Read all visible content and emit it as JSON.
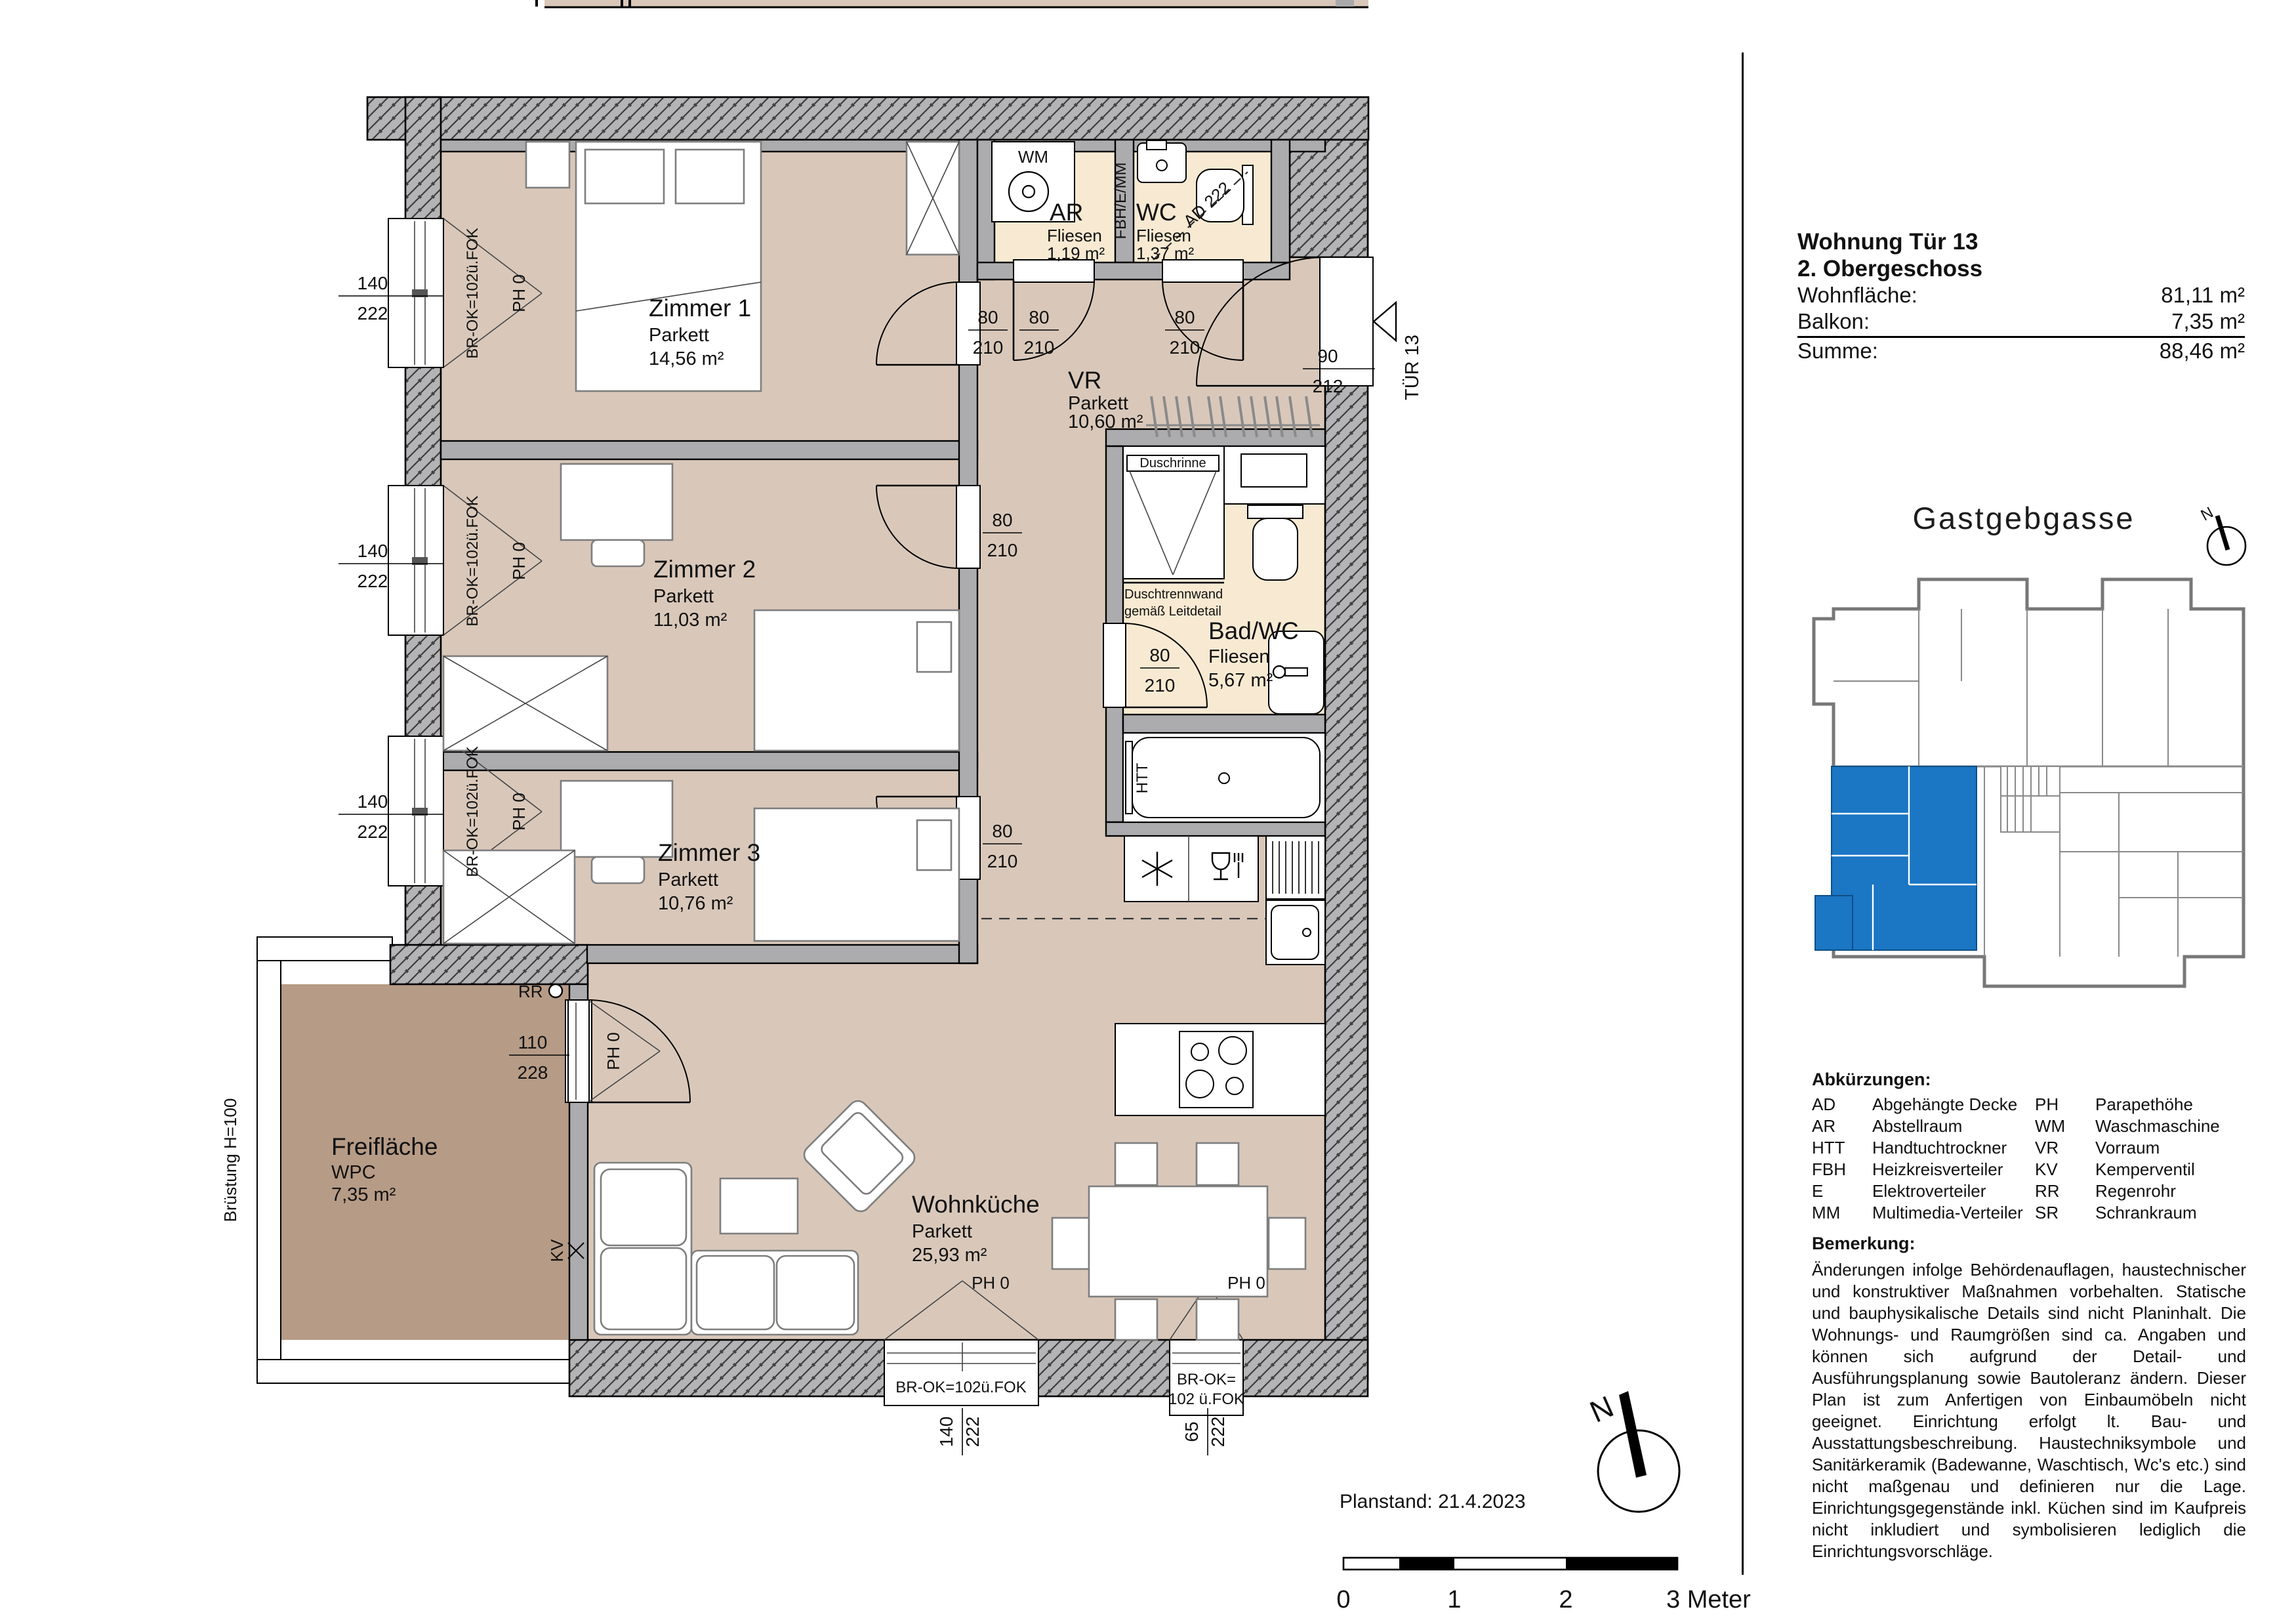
{
  "info": {
    "title": "Wohnung Tür 13",
    "floor": "2. Obergeschoss",
    "rows": [
      {
        "label": "Wohnfläche:",
        "value": "81,11 m²"
      },
      {
        "label": "Balkon:",
        "value": "7,35 m²"
      },
      {
        "label": "Summe:",
        "value": "88,46 m²"
      }
    ]
  },
  "site": {
    "street": "Gastgebgasse"
  },
  "rooms": {
    "z1": {
      "name": "Zimmer 1",
      "floor": "Parkett",
      "area": "14,56 m²"
    },
    "z2": {
      "name": "Zimmer 2",
      "floor": "Parkett",
      "area": "11,03 m²"
    },
    "z3": {
      "name": "Zimmer 3",
      "floor": "Parkett",
      "area": "10,76 m²"
    },
    "vr": {
      "name": "VR",
      "floor": "Parkett",
      "area": "10,60 m²"
    },
    "ar": {
      "name": "AR",
      "floor": "Fliesen",
      "area": "1,19 m²"
    },
    "wc": {
      "name": "WC",
      "floor": "Fliesen",
      "area": "1,37 m²"
    },
    "bad": {
      "name": "Bad/WC",
      "floor": "Fliesen",
      "area": "5,67 m²"
    },
    "wk": {
      "name": "Wohnküche",
      "floor": "Parkett",
      "area": "25,93 m²"
    },
    "frei": {
      "name": "Freifläche",
      "floor": "WPC",
      "area": "7,35 m²"
    }
  },
  "dims": {
    "w80": "80",
    "h210": "210",
    "w140": "140",
    "h222": "222",
    "w90": "90",
    "h212": "212",
    "w110": "110",
    "h228": "228",
    "w65": "65"
  },
  "marks": {
    "ph0": "PH 0",
    "brok": "BR-OK=102ü.FOK",
    "brok_l1": "BR-OK=",
    "brok_l2": "102 ü.FOK",
    "tuer": "TÜR 13",
    "wm": "WM",
    "htt": "HTT",
    "shaft": "FBH/E/MM",
    "ad": "AD 222",
    "kv": "KV",
    "rr": "RR",
    "duschrinne": "Duschrinne",
    "trennwand1": "Duschtrennwand",
    "trennwand2": "gemäß Leitdetail",
    "bruestung": "Brüstung H=100",
    "north": "N"
  },
  "abbr": {
    "title": "Abkürzungen:",
    "items": [
      [
        "AD",
        "Abgehängte Decke"
      ],
      [
        "AR",
        "Abstellraum"
      ],
      [
        "HTT",
        "Handtuchtrockner"
      ],
      [
        "FBH",
        "Heizkreisverteiler"
      ],
      [
        "E",
        "Elektroverteiler"
      ],
      [
        "MM",
        "Multimedia-Verteiler"
      ],
      [
        "PH",
        "Parapethöhe"
      ],
      [
        "WM",
        "Waschmaschine"
      ],
      [
        "VR",
        "Vorraum"
      ],
      [
        "KV",
        "Kemperventil"
      ],
      [
        "RR",
        "Regenrohr"
      ],
      [
        "SR",
        "Schrankraum"
      ]
    ]
  },
  "remark": {
    "title": "Bemerkung:",
    "text": "Änderungen infolge Behördenauflagen, haustechnischer und konstruktiver Maßnahm­en vorbehalten. Statische und bauphysikalische Details sind nicht Planinhalt. Die Wohnungs- und Raumgrößen sind ca. Angaben und können sich aufgrund der Detail- und Ausführungsplanung sowie Bautoleranz ändern. Dieser Plan ist zum Anfertigen von Einbaumöbeln nicht geeignet. Einrichtung erfolgt lt. Bau- und Ausstattungsbeschreibung. Haustechniksymbole und Sanitärkeramik (Badewanne, Waschtisch, Wc's etc.) sind nicht maßgenau und definieren nur die Lage. Einrichtungsgegenstände inkl. Küchen sind im Kaufpreis nicht inkludiert und symbolisieren lediglich die Einrichtungsvorschläge."
  },
  "footer": {
    "planstand_label": "Planstand:",
    "planstand_date": "21.4.2023"
  },
  "scale": {
    "t0": "0",
    "t1": "1",
    "t2": "2",
    "t3": "3 Meter"
  }
}
